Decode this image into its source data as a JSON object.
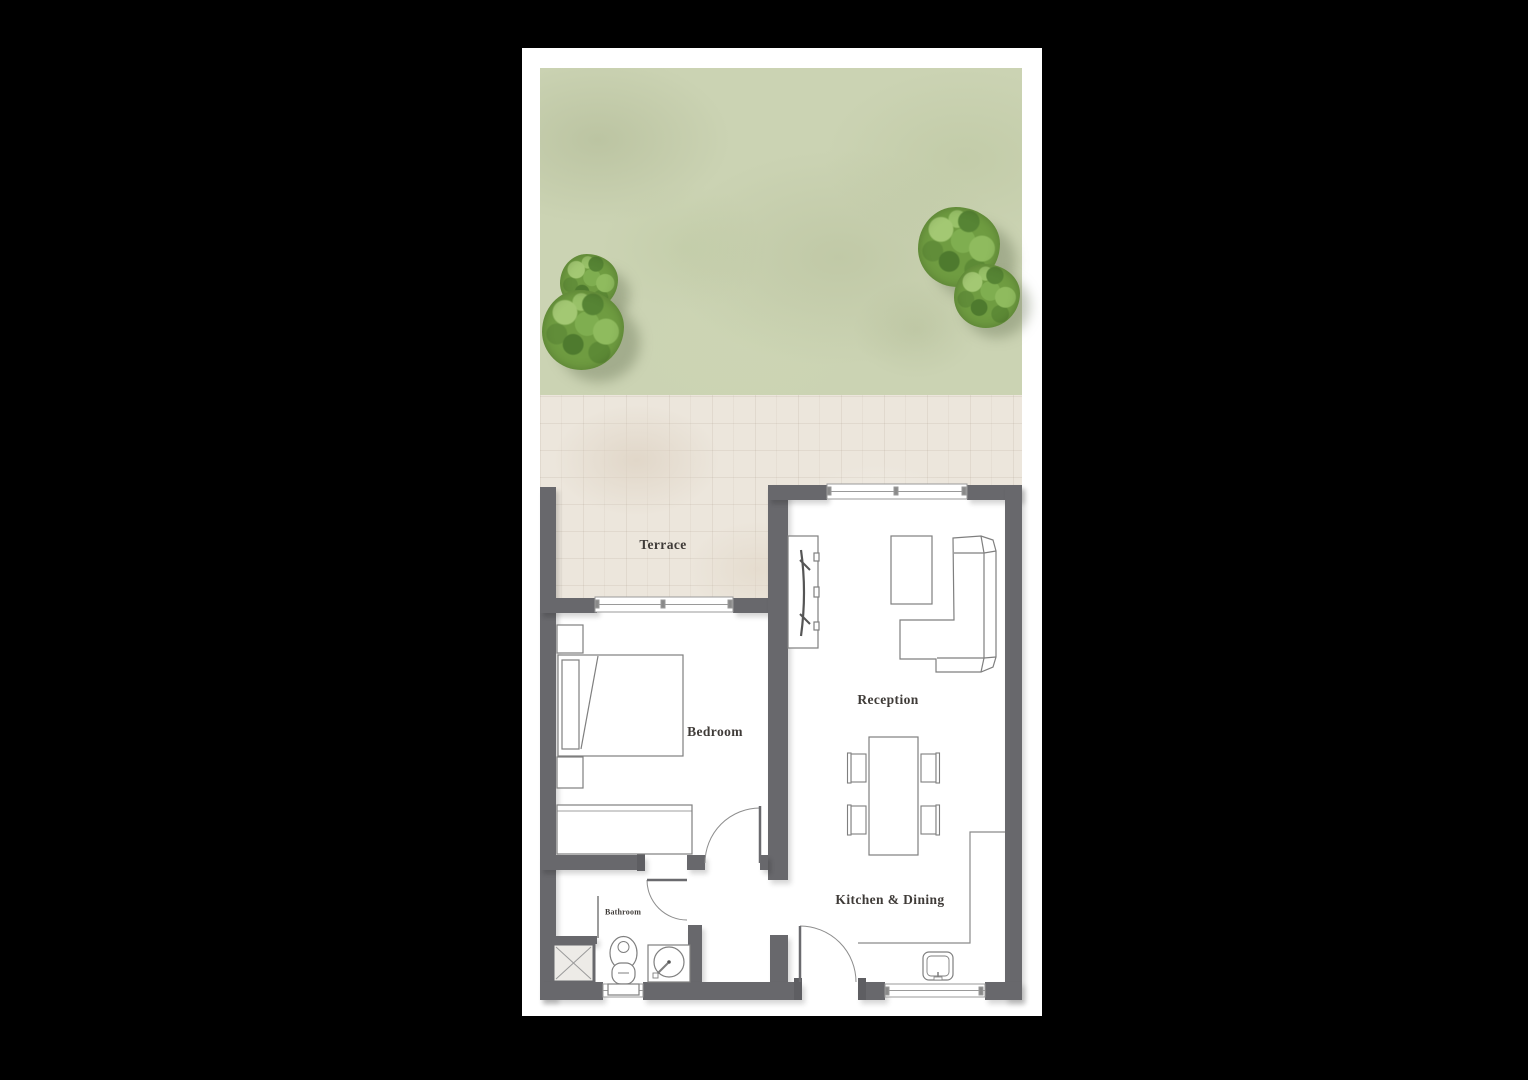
{
  "floorplan": {
    "rooms": {
      "terrace": "Terrace",
      "bedroom": "Bedroom",
      "reception": "Reception",
      "kitchen_dining": "Kitchen & Dining",
      "bathroom": "Bathroom"
    }
  },
  "colors": {
    "page_background": "#000000",
    "card_background": "#ffffff",
    "wall": "#68686c",
    "lawn": "#cbd3b3",
    "tree": "#6f9c41",
    "paving": "#ece6dc",
    "furniture_line": "#7f7f7f",
    "label_text": "#3f3b38"
  }
}
